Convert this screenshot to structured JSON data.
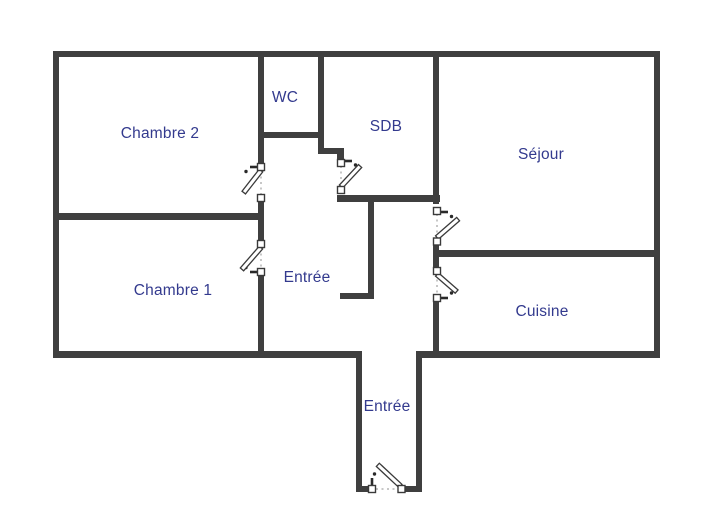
{
  "colors": {
    "background": "#ffffff",
    "wall": "#3f3f3f",
    "label": "#333a8e",
    "door_stroke": "#3a3a3a",
    "opening_dots": "#8f8f8f"
  },
  "rooms": {
    "chambre2": "Chambre 2",
    "wc": "WC",
    "sdb": "SDB",
    "sejour": "Séjour",
    "chambre1": "Chambre 1",
    "entree_hall": "Entrée",
    "cuisine": "Cuisine",
    "entree_entrance": "Entrée"
  }
}
